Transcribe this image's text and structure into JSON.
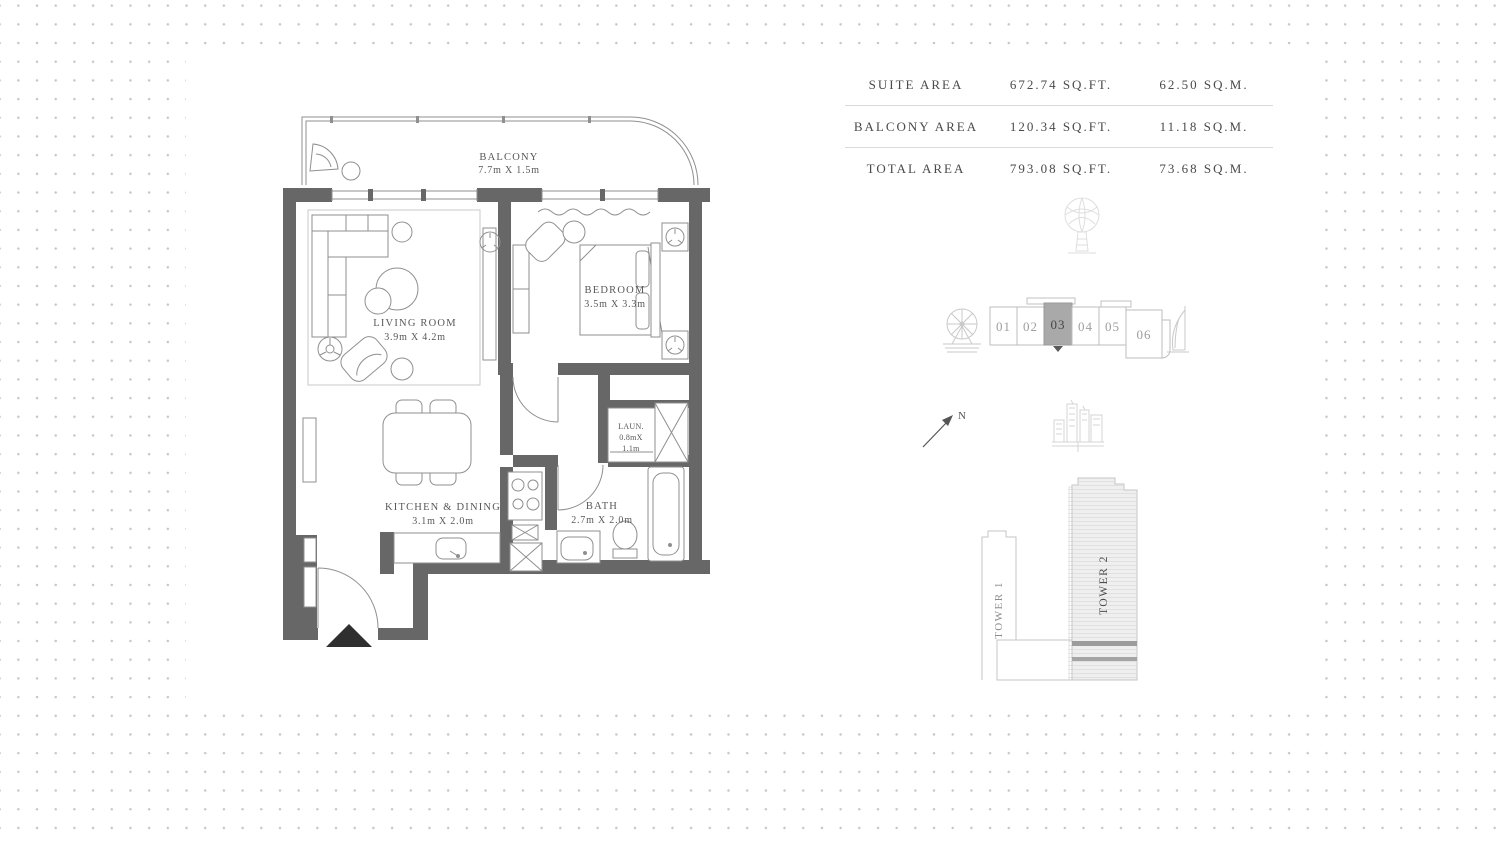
{
  "area_table": {
    "rows": [
      {
        "label": "SUITE AREA",
        "sqft": "672.74 SQ.FT.",
        "sqm": "62.50 SQ.M."
      },
      {
        "label": "BALCONY AREA",
        "sqft": "120.34 SQ.FT.",
        "sqm": "11.18 SQ.M."
      },
      {
        "label": "TOTAL AREA",
        "sqft": "793.08 SQ.FT.",
        "sqm": "73.68 SQ.M."
      }
    ]
  },
  "floor_plan": {
    "rooms": [
      {
        "id": "balcony",
        "name": "BALCONY",
        "dims": "7.7m X 1.5m"
      },
      {
        "id": "living",
        "name": "LIVING ROOM",
        "dims": "3.9m X 4.2m"
      },
      {
        "id": "bedroom",
        "name": "BEDROOM",
        "dims": "3.5m X 3.3m"
      },
      {
        "id": "kitchen",
        "name": "KITCHEN & DINING",
        "dims": "3.1m X 2.0m"
      },
      {
        "id": "bath",
        "name": "BATH",
        "dims": "2.7m X 2.0m"
      },
      {
        "id": "laundry",
        "name": "LAUN.",
        "dims_line1": "0.8mX",
        "dims_line2": "1.1m"
      }
    ]
  },
  "unit_selector": {
    "units": [
      "01",
      "02",
      "03",
      "04",
      "05",
      "06"
    ],
    "selected": "03",
    "selected_fill": "#a9a9a9"
  },
  "compass": {
    "label": "N"
  },
  "towers": [
    {
      "label": "TOWER 1",
      "highlighted": false
    },
    {
      "label": "TOWER 2",
      "highlighted": true
    }
  ],
  "colors": {
    "wall": "#676767",
    "dots": "#c6c6c6",
    "furniture_line": "#8f8f8f",
    "table_divider": "#d9d9d9",
    "tower2_fill": "#efefef",
    "highlight_band": "#9c9c9c"
  },
  "icons": {
    "palm": "palm-tree-icon",
    "ferris_wheel": "ferris-wheel-icon",
    "burj": "burj-al-arab-icon",
    "skyline": "city-skyline-icon",
    "north": "north-arrow-icon",
    "entry": "entry-marker-icon"
  }
}
